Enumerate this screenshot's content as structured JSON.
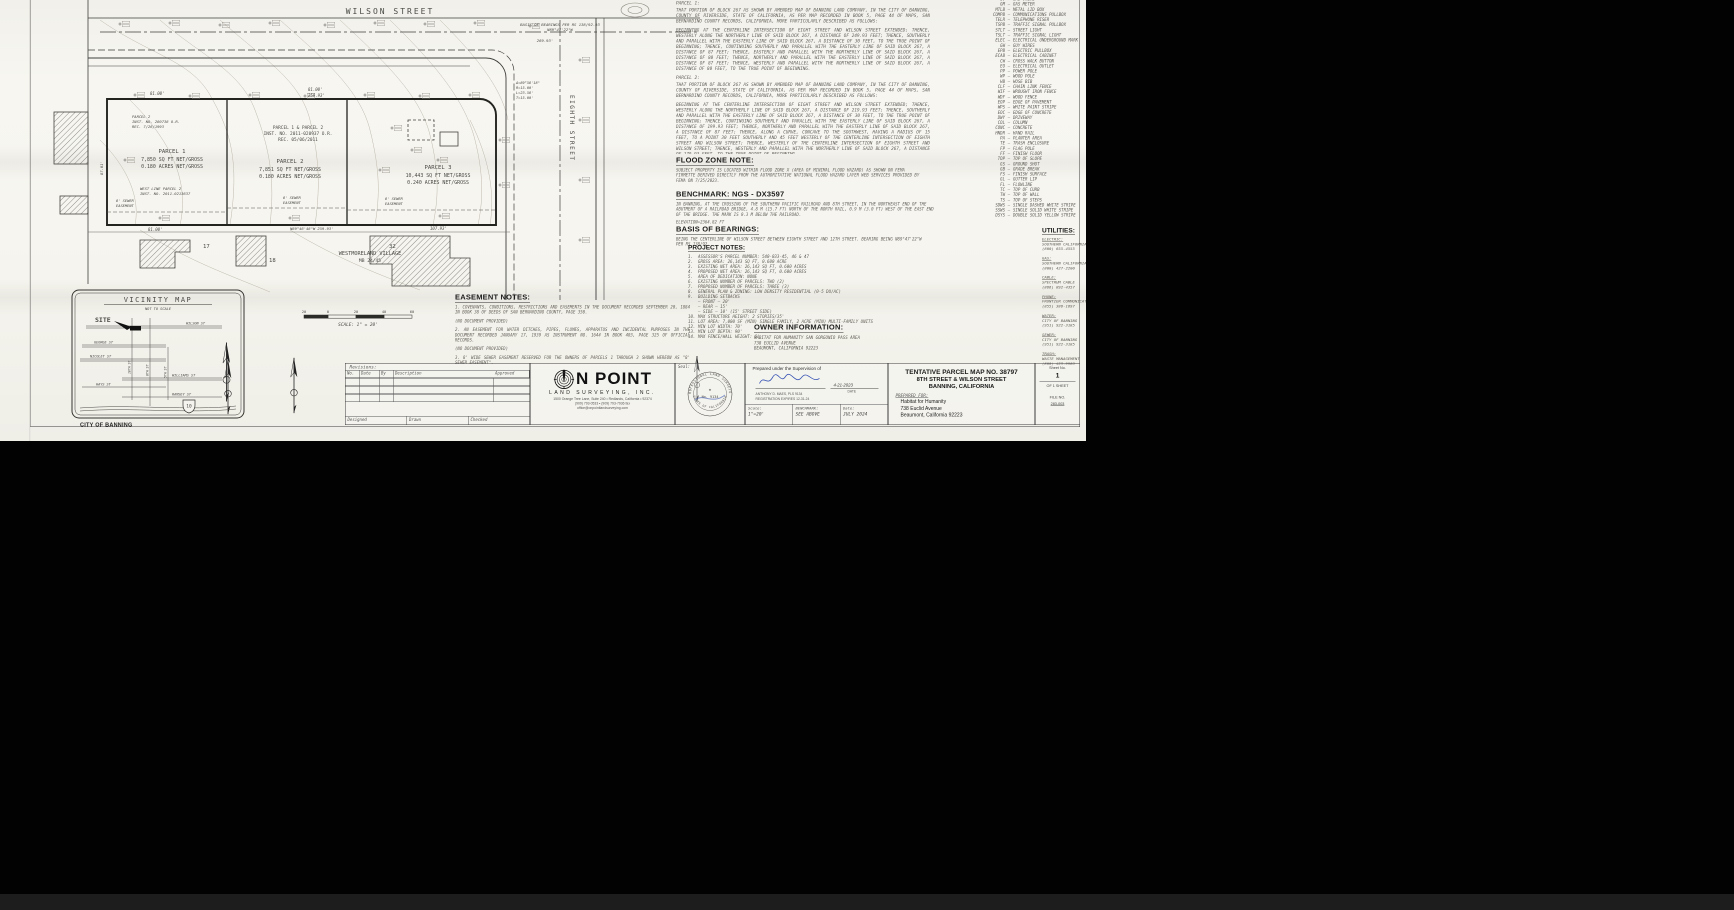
{
  "map": {
    "wilson_street": "WILSON STREET",
    "eighth_street": "EIGHTH STREET",
    "basis_note_1": "BASIS OF BEARINGS PER RS 138/92-93",
    "basis_note_2": "N89°47'22\"W",
    "dim_269": "269.93'",
    "dim_81_p1": "81.00'",
    "dim_81_p2": "81.00'",
    "dim_259_p2": "259.93'",
    "dim_81_bottom": "81.00'",
    "bottom_bearing": "N89°46'48\"W  259.93'",
    "dim_107": "107.93'",
    "dim_left_87": "87.01'",
    "curve_delta": "Δ=89°58'18\"",
    "curve_r": "R=15.00'",
    "curve_l": "L=23.56'",
    "curve_t": "T=15.00'",
    "parcels": [
      {
        "name": "PARCEL 1",
        "area": "7,850 SQ FT NET/GROSS",
        "acres": "0.180 ACRES NET/GROSS"
      },
      {
        "name": "PARCEL 2",
        "area": "7,851 SQ FT NET/GROSS",
        "acres": "0.180 ACRES NET/GROSS"
      },
      {
        "name": "PARCEL 3",
        "area": "10,443 SQ FT NET/GROSS",
        "acres": "0.240 ACRES NET/GROSS"
      }
    ],
    "inst_note": [
      "PARCEL 1 & PARCEL 2",
      "INST. NO. 2011-020937 O.R.",
      "REC. 05/06/2011"
    ],
    "hist_note": [
      "PARCEL 2",
      "INST. NO. 280738 O.R.",
      "REC. 7/26/1993"
    ],
    "west_note": [
      "WEST LINE PARCEL 2",
      "INST. NO. 2011-0213637"
    ],
    "sewer_1": "8' SEWER",
    "sewer_2": "EASEMENT",
    "village_1": "WESTMORELAND VILLAGE",
    "village_2": "MB 24/45",
    "lot_17": "17",
    "lot_18": "18",
    "lot_32": "32"
  },
  "legal": {
    "parcel1_heading": "PARCEL 1:",
    "parcel1_paragraphs": [
      "THAT PORTION OF BLOCK 267 AS SHOWN BY AMENDED MAP OF BANNING LAND COMPANY, IN THE CITY OF BANNING, COUNTY OF RIVERSIDE, STATE OF CALIFORNIA, AS PER MAP RECORDED IN BOOK 5, PAGE 44 OF MAPS, SAN BERNARDINO COUNTY RECORDS, CALIFORNIA, MORE PARTICULARLY DESCRIBED AS FOLLOWS:",
      "BEGINNING AT THE CENTERLINE INTERSECTION OF EIGHT STREET AND WILSON STREET EXTENDED; THENCE, WESTERLY ALONG THE NORTHERLY LINE OF SAID BLOCK 267, A DISTANCE OF 249.93 FEET; THENCE, SOUTHERLY AND PARALLEL WITH THE EASTERLY LINE OF SAID BLOCK 267, A DISTANCE OF 30 FEET, TO THE TRUE POINT OF BEGINNING; THENCE, CONTINUING SOUTHERLY AND PARALLEL WITH THE EASTERLY LINE OF SAID BLOCK 267, A DISTANCE OF 87 FEET; THENCE, EASTERLY AND PARALLEL WITH THE NORTHERLY LINE OF SAID BLOCK 267, A DISTANCE OF 80 FEET; THENCE, NORTHERLY AND PARALLEL WITH THE EASTERLY LINE OF SAID BLOCK 267, A DISTANCE OF 87 FEET; THENCE, WESTERLY AND PARALLEL WITH THE NORTHERLY LINE OF SAID BLOCK 267, A DISTANCE OF 80 FEET, TO THE TRUE POINT OF BEGINNING."
    ],
    "parcel2_heading": "PARCEL 2:",
    "parcel2_paragraphs": [
      "THAT PORTION OF BLOCK 267 AS SHOWN BY AMENDED MAP OF BANNING LAND COMPANY, IN THE CITY OF BANNING, COUNTY OF RIVERSIDE, STATE OF CALIFORNIA, AS PER MAP RECORDED IN BOOK 5, PAGE 44 OF MAPS, SAN BERNARDINO COUNTY RECORDS, CALIFORNIA, MORE PARTICULARLY DESCRIBED AS FOLLOWS:",
      "BEGINNING AT THE CENTERLINE INTERSECTION OF EIGHT STREET AND WILSON STREET EXTENDED; THENCE, WESTERLY ALONG THE NORTHERLY LINE OF SAID BLOCK 267, A DISTANCE OF 219.93 FEET; THENCE, SOUTHERLY AND PARALLEL WITH THE EASTERLY LINE OF SAID BLOCK 267, A DISTANCE OF 30 FEET, TO THE TRUE POINT OF BEGINNING; THENCE, CONTINUING SOUTHERLY AND PARALLEL WITH THE EASTERLY LINE OF SAID BLOCK 267, A DISTANCE OF 199.93 FEET; THENCE, NORTHERLY AND PARALLEL WITH THE EASTERLY LINE OF SAID BLOCK 267, A DISTANCE OF 87 FEET; THENCE, ALONG A CURVE, CONCAVE TO THE SOUTHWEST, HAVING A RADIUS OF 15 FEET, TO A POINT 30 FEET SOUTHERLY AND 45 FEET WESTERLY OF THE CENTERLINE INTERSECTION OF EIGHTH STREET AND WILSON STREET; THENCE, WESTERLY OF THE CENTERLINE INTERSECTION OF EIGHTH STREET AND WILSON STREET; THENCE, WESTERLY AND PARALLEL WITH THE NORTHERLY LINE OF SAID BLOCK 267, A DISTANCE OF 179.93 FEET, TO THE TRUE POINT OF BEGINNING."
    ]
  },
  "flood": {
    "heading": "FLOOD ZONE NOTE:",
    "body": "SUBJECT PROPERTY IS LOCATED WITHIN FLOOD ZONE X (AREA OF MINIMAL FLOOD HAZARD) AS SHOWN ON FEMA FIRMETTE DERIVED DIRECTLY FROM THE AUTHORITATIVE NATIONAL FLOOD HAZARD LAYER WEB SERVICES PROVIDED BY FEMA ON 7/25/2023."
  },
  "benchmark": {
    "heading": "BENCHMARK: NGS - DX3597",
    "body": "IN BANNING, AT THE CROSSING OF THE SOUTHERN PACIFIC RAILROAD AND 8TH STREET, IN THE NORTHEAST END OF THE ABUTMENT OF A RAILROAD BRIDGE, 4.8 M (15.7 FT) NORTH OF THE NORTH RAIL, 0.9 M (3.0 FT) WEST OF THE EAST END OF THE BRIDGE. THE MARK IS 0.3 M BELOW THE RAILROAD.",
    "elevation": "ELEVATION=2364.82 FT"
  },
  "bearings": {
    "heading": "BASIS OF BEARINGS:",
    "body": "BEING THE CENTERLINE OF WILSON STREET BETWEEN EIGHTH STREET AND 12TH STREET. BEARING BEING N89°47'22\"W PER RS 138/92."
  },
  "project_notes": {
    "heading": "PROJECT NOTES:",
    "items": [
      {
        "no": "1.",
        "text": "ASSESSOR'S PARCEL NUMBER: 540-033-45, 46 & 47"
      },
      {
        "no": "2.",
        "text": "GROSS AREA: 26,143 SQ FT, 0.600 ACRE"
      },
      {
        "no": "3.",
        "text": "EXISTING NET AREA: 26,143 SQ FT, 0.600 ACRES"
      },
      {
        "no": "4.",
        "text": "PROPOSED NET AREA: 26,143 SQ FT, 0.600 ACRES"
      },
      {
        "no": "5.",
        "text": "AREA OF DEDICATION: NONE"
      },
      {
        "no": "6.",
        "text": "EXISTING NUMBER OF PARCELS: TWO (2)"
      },
      {
        "no": "7.",
        "text": "PROPOSED NUMBER OF PARCELS: THREE (3)"
      },
      {
        "no": "8.",
        "text": "GENERAL PLAN & ZONING: LOW DENSITY RESIDENTIAL (0-5 DU/AC)"
      },
      {
        "no": "9.",
        "text": "BUILDING SETBACKS"
      },
      {
        "no": "",
        "text": "—  FRONT — 20'"
      },
      {
        "no": "",
        "text": "—  REAR — 15'"
      },
      {
        "no": "",
        "text": "—  SIDE — 10' (15' STREET SIDE)"
      },
      {
        "no": "10.",
        "text": "MAX STRUCTURE HEIGHT: 2 STORIES/35'"
      },
      {
        "no": "11.",
        "text": "LOT AREA: 7,000 SF (MIN) SINGLE FAMILY, 2 ACRE (MIN) MULTI-FAMILY UNITS"
      },
      {
        "no": "12.",
        "text": "MIN LOT WIDTH: 70'"
      },
      {
        "no": "13.",
        "text": "MIN LOT DEPTH: 90'"
      },
      {
        "no": "14.",
        "text": "MAX FENCE/WALL HEIGHT: 6'"
      }
    ]
  },
  "easement": {
    "heading": "EASEMENT NOTES:",
    "paragraphs": [
      "1. COVENANTS, CONDITIONS, RESTRICTIONS AND EASEMENTS IN THE DOCUMENT RECORDED SEPTEMBER 20, 1884 IN BOOK 38 OF DEEDS OF SAN BERNARDINO COUNTY, PAGE 350.",
      "(NO DOCUMENT PROVIDED)",
      "2. AN EASEMENT FOR WATER DITCHES, PIPES, FLUMES, APPARATUS AND INCIDENTAL PURPOSES IN THE DOCUMENT RECORDED JANUARY 17, 1939 AS INSTRUMENT NO. 1644 IN BOOK 403, PAGE 325 OF OFFICIAL RECORDS.",
      "(NO DOCUMENT PROVIDED)",
      "3. 8' WIDE SEWER EASEMENT RESERVED FOR THE OWNERS OF PARCELS 1 THROUGH 3 SHOWN HEREON AS \"8' SEWER EASEMENT\"."
    ]
  },
  "owner": {
    "heading": "OWNER INFORMATION:",
    "lines": [
      "HABITAT FOR HUMANITY SAN GORGONIO PASS AREA",
      "738 EUCLID AVENUE",
      "BEAUMONT, CALIFORNIA 92223"
    ]
  },
  "legend": {
    "sep": "—",
    "items": [
      {
        "a": "GV",
        "d": "GAS VALVE"
      },
      {
        "a": "GM",
        "d": "GAS METER"
      },
      {
        "a": "MTLB",
        "d": "METAL LID BOX"
      },
      {
        "a": "COMPB",
        "d": "COMMUNICATIONS PULLBOX"
      },
      {
        "a": "TELR",
        "d": "TELEPHONE RISER"
      },
      {
        "a": "TSPB",
        "d": "TRAFFIC SIGNAL PULLBOX"
      },
      {
        "a": "STLT",
        "d": "STREET LIGHT"
      },
      {
        "a": "TSLT",
        "d": "TRAFFIC SIGNAL LIGHT"
      },
      {
        "a": "ELEC",
        "d": "ELECTRICAL UNDERGROUND MARK"
      },
      {
        "a": "GW",
        "d": "GUY WIRES"
      },
      {
        "a": "EPB",
        "d": "ELECTRIC PULLBOX"
      },
      {
        "a": "ECAB",
        "d": "ELECTRICAL CABINET"
      },
      {
        "a": "CW",
        "d": "CROSS WALK BUTTON"
      },
      {
        "a": "EO",
        "d": "ELECTRICAL OUTLET"
      },
      {
        "a": "PP",
        "d": "POWER POLE"
      },
      {
        "a": "WP",
        "d": "WOOD POLE"
      },
      {
        "a": "HB",
        "d": "HOSE BIB"
      },
      {
        "a": "CLF",
        "d": "CHAIN LINK FENCE"
      },
      {
        "a": "WIF",
        "d": "WROUGHT IRON FENCE"
      },
      {
        "a": "WDF",
        "d": "WOOD FENCE"
      },
      {
        "a": "EOP",
        "d": "EDGE OF PAVEMENT"
      },
      {
        "a": "WPS",
        "d": "WHITE PAINT STRIPE"
      },
      {
        "a": "EOC",
        "d": "EDGE OF CONCRETE"
      },
      {
        "a": "DWY",
        "d": "DRIVEWAY"
      },
      {
        "a": "COL",
        "d": "COLUMN"
      },
      {
        "a": "CONC",
        "d": "CONCRETE"
      },
      {
        "a": "HNDR",
        "d": "HAND RAIL"
      },
      {
        "a": "PA",
        "d": "PLANTER AREA"
      },
      {
        "a": "TE",
        "d": "TRASH ENCLOSURE"
      },
      {
        "a": "FP",
        "d": "FLAG POLE"
      },
      {
        "a": "FF",
        "d": "FINISH FLOOR"
      },
      {
        "a": "TOP",
        "d": "TOP OF SLOPE"
      },
      {
        "a": "GS",
        "d": "GROUND SHOT"
      },
      {
        "a": "GB",
        "d": "GRADE BREAK"
      },
      {
        "a": "FS",
        "d": "FINISH SURFACE"
      },
      {
        "a": "GL",
        "d": "GUTTER LIP"
      },
      {
        "a": "FL",
        "d": "FLOWLINE"
      },
      {
        "a": "TC",
        "d": "TOP OF CURB"
      },
      {
        "a": "TW",
        "d": "TOP OF WALL"
      },
      {
        "a": "TS",
        "d": "TOP OF STEPS"
      },
      {
        "a": "SDWS",
        "d": "SINGLE DASHED WHITE STRIPE"
      },
      {
        "a": "SSWS",
        "d": "SINGLE SOLID WHITE STRIPE"
      },
      {
        "a": "DSYS",
        "d": "DOUBLE SOLID YELLOW STRIPE"
      }
    ]
  },
  "utilities": {
    "heading": "UTILITIES:",
    "entries": [
      {
        "service": "ELECTRIC:",
        "provider": "SOUTHERN CALIFORNIA EDISON COMPANY",
        "phone": "(800) 655-4555"
      },
      {
        "service": "GAS:",
        "provider": "SOUTHERN CALIFORNIA GAS COMPANY",
        "phone": "(800) 427-2200"
      },
      {
        "service": "CABLE:",
        "provider": "SPECTRUM CABLE",
        "phone": "(866) 892-4357"
      },
      {
        "service": "PHONE:",
        "provider": "FRONTIER COMMUNICATIONS",
        "phone": "(855) 386-1697"
      },
      {
        "service": "WATER:",
        "provider": "CITY OF BANNING",
        "phone": "(951) 922-3185"
      },
      {
        "service": "SEWER:",
        "provider": "CITY OF BANNING",
        "phone": "(951) 922-3185"
      },
      {
        "service": "TRASH:",
        "provider": "WASTE MANAGEMENT",
        "phone": "(800) 423-9986"
      }
    ]
  },
  "vicinity": {
    "title": "VICINITY MAP",
    "subtitle": "NOT TO SCALE",
    "site_label": "SITE",
    "city_label": "CITY OF BANNING",
    "h_streets": [
      "WILSON ST",
      "GEORGE ST",
      "NICOLET ST",
      "WILLIAMS ST",
      "HAYS ST",
      "RAMSEY ST"
    ],
    "v_streets": [
      "10TH ST",
      "8TH ST",
      "5TH ST"
    ],
    "shield": "10"
  },
  "scalebar": {
    "ticks": [
      "20",
      "0",
      "20",
      "40",
      "60"
    ],
    "label": "SCALE: 1\" = 20'"
  },
  "revisions": {
    "title": "Revisions:",
    "columns": [
      "No.",
      "Date",
      "By",
      "Description",
      "Approved"
    ],
    "footer": [
      "Designed",
      "Drawn",
      "Checked"
    ]
  },
  "surveyor": {
    "logo_rest": "N POINT",
    "sub": "LAND SURVEYING, INC.",
    "addr": "1500 Orange Tree Lane, Suite 240 • Redlands, California • 92374",
    "phone": "(909) 793-0533 • (909) 793-7936 fax",
    "email": "office@onpointlandsurveying.com"
  },
  "seal": {
    "label": "Seal:",
    "ring_top": "PROFESSIONAL LAND SURVEYOR",
    "ring_bottom": "STATE OF CALIFORNIA",
    "no": "No. 9134",
    "star": "★"
  },
  "prepared": {
    "line": "Prepared under the Supervision of",
    "date_value": "4-21-2023",
    "date_label": "DATE",
    "name": "ANTHONY D. MAES, PLS 9134",
    "expires": "REGISTRATION EXPIRES 12-31-24"
  },
  "info_row": {
    "scale_label": "Scale:",
    "scale_value": "1\"=20'",
    "benchmark_label": "BENCHMARK:",
    "benchmark_value": "SEE ABOVE",
    "date_label": "Date:",
    "date_value": "JULY 2024"
  },
  "titleblock": {
    "line1": "TENTATIVE PARCEL MAP NO. 38797",
    "line2": "8TH STREET & WILSON STREET",
    "line3": "BANNING, CALIFORNIA",
    "prepared_for": "PREPARED FOR:",
    "client": [
      "Habitat for Humanity",
      "738 Euclid Avenue",
      "Beaumont, California 92223"
    ]
  },
  "sheetno": {
    "label": "Sheet No.",
    "value": "1",
    "of": "OF 1 SHEET",
    "file_label": "FILE NO.",
    "file_value": "283-003"
  }
}
